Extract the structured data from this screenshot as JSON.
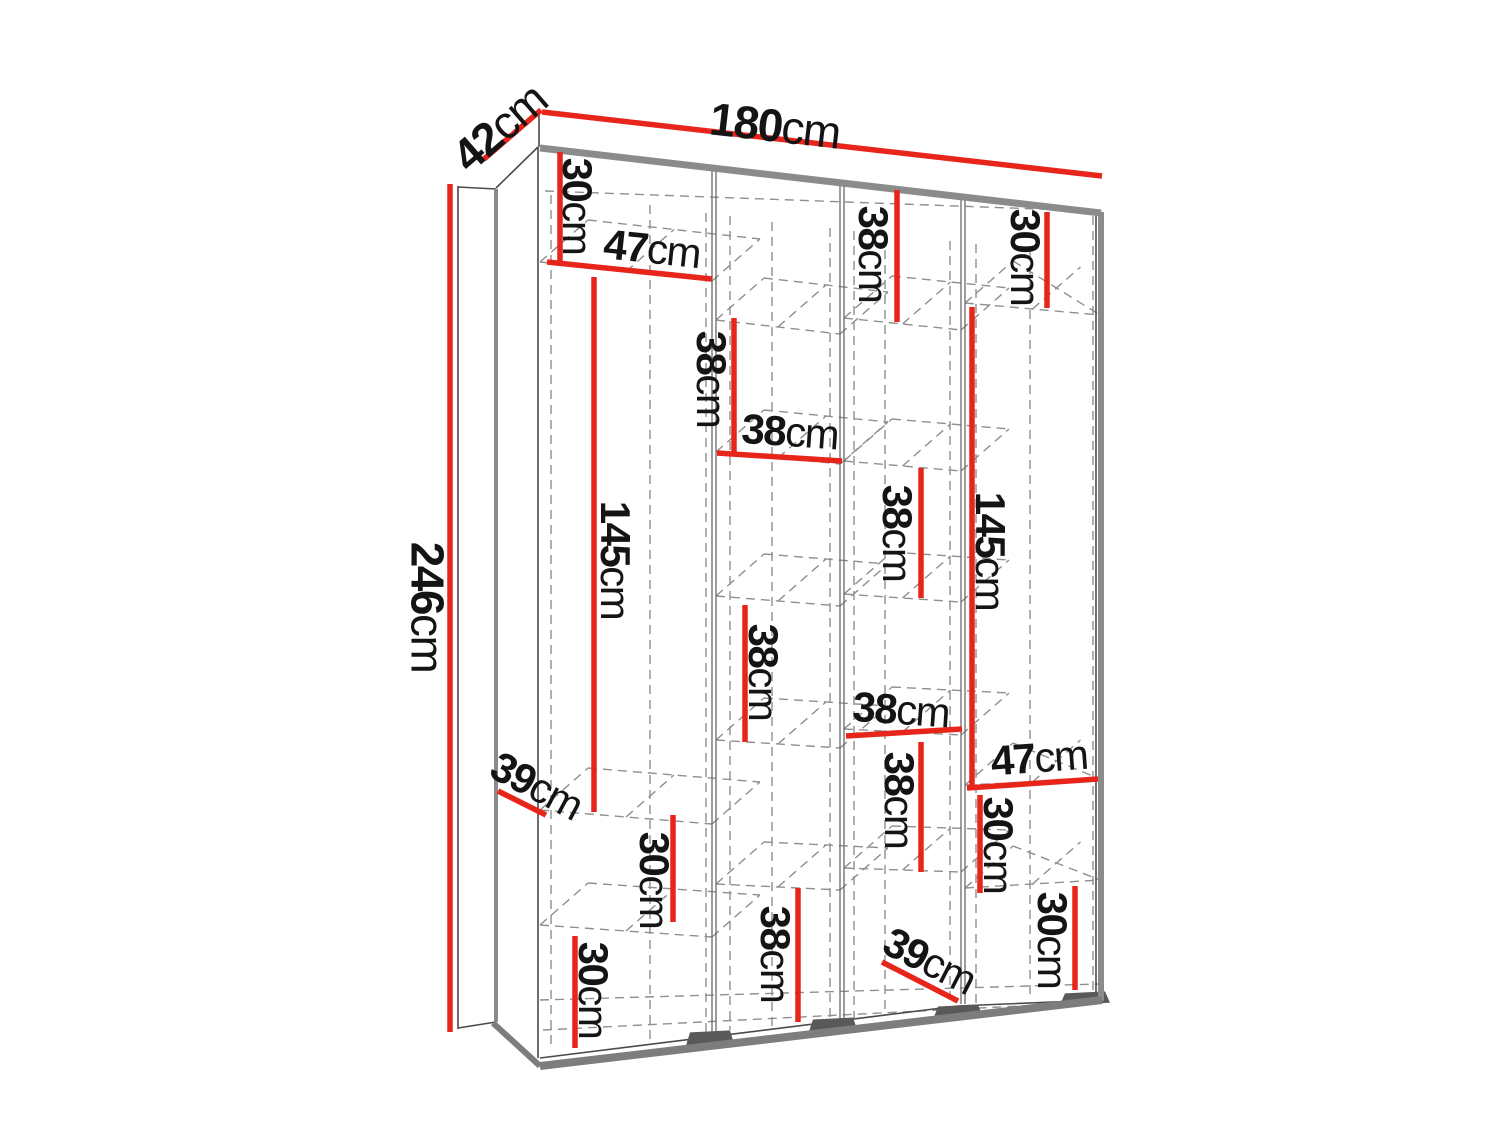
{
  "diagram": {
    "type": "furniture-dimension-diagram",
    "subject": "wardrobe-3d-wireframe-with-shelf-dimensions",
    "unit": "cm",
    "canvas": {
      "width": 1500,
      "height": 1125
    },
    "colors": {
      "background": "#ffffff",
      "dimension_red": "#e8251b",
      "edge_gray": "#8b8b8b",
      "base_gray": "#7d7d7d",
      "feet_gray": "#595959",
      "thin_line": "#4a4a4a",
      "partition_line": "#6a6a6a",
      "dashed_line": "#8f8f8f",
      "text": "#141414"
    },
    "overall_dimensions": [
      {
        "id": "depth",
        "value": "42",
        "unit": "cm",
        "line": [
          484,
          159,
          541,
          110
        ],
        "label": {
          "x": 499,
          "y": 127,
          "rot": -41,
          "size": 46
        }
      },
      {
        "id": "width",
        "value": "180",
        "unit": "cm",
        "line": [
          542,
          112,
          1102,
          176
        ],
        "label": {
          "x": 775,
          "y": 125,
          "rot": 6.5,
          "size": 46
        }
      },
      {
        "id": "height",
        "value": "246",
        "unit": "cm",
        "line": [
          450,
          184,
          450,
          1032
        ],
        "label": {
          "x": 428,
          "y": 607,
          "rot": 90,
          "size": 46
        }
      }
    ],
    "internal_dimensions": [
      {
        "id": "c1-top-30",
        "value": "30",
        "unit": "cm",
        "line": [
          560,
          152,
          560,
          262
        ],
        "label": {
          "x": 578,
          "y": 206,
          "rot": 90
        }
      },
      {
        "id": "c1-width-47",
        "value": "47",
        "unit": "cm",
        "line": [
          547,
          262,
          712,
          279
        ],
        "label": {
          "x": 652,
          "y": 248,
          "rot": 6
        }
      },
      {
        "id": "c1-hang-145",
        "value": "145",
        "unit": "cm",
        "line": [
          594,
          277,
          594,
          812
        ],
        "label": {
          "x": 616,
          "y": 560,
          "rot": 90
        }
      },
      {
        "id": "c1-depth-39",
        "value": "39",
        "unit": "cm",
        "line": [
          498,
          791,
          546,
          815
        ],
        "label": {
          "x": 537,
          "y": 785,
          "rot": 28
        }
      },
      {
        "id": "c1-mid-30",
        "value": "30",
        "unit": "cm",
        "line": [
          673,
          815,
          673,
          922
        ],
        "label": {
          "x": 655,
          "y": 880,
          "rot": 90
        }
      },
      {
        "id": "c1-bot-30",
        "value": "30",
        "unit": "cm",
        "line": [
          575,
          936,
          575,
          1048
        ],
        "label": {
          "x": 594,
          "y": 990,
          "rot": 90
        }
      },
      {
        "id": "c2-cell-38a",
        "value": "38",
        "unit": "cm",
        "line": [
          734,
          318,
          734,
          453
        ],
        "label": {
          "x": 712,
          "y": 379,
          "rot": 90
        }
      },
      {
        "id": "c2-width-38",
        "value": "38",
        "unit": "cm",
        "line": [
          717,
          453,
          842,
          461
        ],
        "label": {
          "x": 790,
          "y": 431,
          "rot": 4
        }
      },
      {
        "id": "c2-cell-38b",
        "value": "38",
        "unit": "cm",
        "line": [
          745,
          605,
          745,
          742
        ],
        "label": {
          "x": 764,
          "y": 672,
          "rot": 90
        }
      },
      {
        "id": "c2-bot-38",
        "value": "38",
        "unit": "cm",
        "line": [
          798,
          888,
          798,
          1022
        ],
        "label": {
          "x": 776,
          "y": 954,
          "rot": 90
        }
      },
      {
        "id": "c3-top-38",
        "value": "38",
        "unit": "cm",
        "line": [
          897,
          190,
          897,
          322
        ],
        "label": {
          "x": 874,
          "y": 254,
          "rot": 90
        }
      },
      {
        "id": "c3-cell-38a",
        "value": "38",
        "unit": "cm",
        "line": [
          921,
          468,
          921,
          598
        ],
        "label": {
          "x": 898,
          "y": 533,
          "rot": 90
        }
      },
      {
        "id": "c3-width-38",
        "value": "38",
        "unit": "cm",
        "line": [
          846,
          736,
          962,
          729
        ],
        "label": {
          "x": 901,
          "y": 709,
          "rot": 4
        }
      },
      {
        "id": "c3-cell-38b",
        "value": "38",
        "unit": "cm",
        "line": [
          921,
          742,
          921,
          872
        ],
        "label": {
          "x": 900,
          "y": 800,
          "rot": 90
        }
      },
      {
        "id": "c3-depth-39",
        "value": "39",
        "unit": "cm",
        "line": [
          882,
          962,
          958,
          1001
        ],
        "label": {
          "x": 930,
          "y": 960,
          "rot": 27
        }
      },
      {
        "id": "c4-top-30",
        "value": "30",
        "unit": "cm",
        "line": [
          1047,
          212,
          1047,
          308
        ],
        "label": {
          "x": 1026,
          "y": 257,
          "rot": 90
        }
      },
      {
        "id": "c4-hang-145",
        "value": "145",
        "unit": "cm",
        "line": [
          972,
          307,
          972,
          788
        ],
        "label": {
          "x": 991,
          "y": 551,
          "rot": 90
        }
      },
      {
        "id": "c4-width-47",
        "value": "47",
        "unit": "cm",
        "line": [
          967,
          788,
          1098,
          779
        ],
        "label": {
          "x": 1039,
          "y": 757,
          "rot": -4
        }
      },
      {
        "id": "c4-mid-30",
        "value": "30",
        "unit": "cm",
        "line": [
          980,
          795,
          980,
          893
        ],
        "label": {
          "x": 999,
          "y": 845,
          "rot": 90
        }
      },
      {
        "id": "c4-bot-30",
        "value": "30",
        "unit": "cm",
        "line": [
          1075,
          886,
          1075,
          990
        ],
        "label": {
          "x": 1053,
          "y": 940,
          "rot": 90
        }
      }
    ],
    "structure": {
      "solid_thin_lines": [
        [
          539,
          111,
          539,
          147
        ],
        [
          538,
          147,
          496,
          188
        ],
        [
          538,
          147,
          538,
          1058
        ],
        [
          1096,
          212,
          1096,
          1001
        ],
        [
          540,
          1058,
          958,
          1006
        ],
        [
          958,
          1006,
          1100,
          1000
        ],
        [
          458,
          186,
          458,
          1029
        ],
        [
          458,
          187,
          496,
          189
        ],
        [
          458,
          1028,
          496,
          1022
        ]
      ],
      "thick_lines": [
        {
          "pts": [
            540,
            148,
            1101,
            213
          ],
          "w": 7,
          "c": "edge"
        },
        {
          "pts": [
            1101,
            212,
            1101,
            1001
          ],
          "w": 6,
          "c": "edge"
        },
        {
          "pts": [
            496,
            189,
            496,
            1022
          ],
          "w": 4,
          "c": "edge"
        },
        {
          "pts": [
            493,
            1023,
            540,
            1066
          ],
          "w": 6,
          "c": "base"
        },
        {
          "pts": [
            540,
            1066,
            1102,
            1000
          ],
          "w": 8,
          "c": "base"
        }
      ],
      "partitions": [
        {
          "x": 712,
          "y1": 167,
          "y2": 1038
        },
        {
          "x": 840,
          "y1": 182,
          "y2": 1022
        },
        {
          "x": 961,
          "y1": 196,
          "y2": 1004
        }
      ],
      "dashed_lines": [
        [
          545,
          191,
          1093,
          211
        ],
        [
          540,
          1000,
          1099,
          984
        ],
        [
          543,
          1030,
          1099,
          1002
        ]
      ],
      "dashed_verticals": [
        [
          551,
          195,
          1050
        ],
        [
          650,
          205,
          1042
        ],
        [
          706,
          213,
          1034
        ],
        [
          730,
          216,
          1030
        ],
        [
          772,
          222,
          1026
        ],
        [
          830,
          228,
          1022
        ],
        [
          854,
          231,
          1018
        ],
        [
          885,
          235,
          1014
        ],
        [
          950,
          241,
          1008
        ],
        [
          976,
          244,
          1004
        ],
        [
          1030,
          250,
          1000
        ],
        [
          1093,
          216,
          996
        ]
      ],
      "shelves": [
        {
          "x1": 540,
          "y1": 262,
          "x2": 712,
          "y2": 281
        },
        {
          "x1": 540,
          "y1": 810,
          "x2": 712,
          "y2": 824
        },
        {
          "x1": 540,
          "y1": 925,
          "x2": 712,
          "y2": 937
        },
        {
          "x1": 716,
          "y1": 320,
          "x2": 840,
          "y2": 334
        },
        {
          "x1": 716,
          "y1": 452,
          "x2": 840,
          "y2": 464
        },
        {
          "x1": 716,
          "y1": 596,
          "x2": 840,
          "y2": 606
        },
        {
          "x1": 716,
          "y1": 740,
          "x2": 840,
          "y2": 748
        },
        {
          "x1": 716,
          "y1": 884,
          "x2": 840,
          "y2": 890
        },
        {
          "x1": 844,
          "y1": 318,
          "x2": 961,
          "y2": 330
        },
        {
          "x1": 844,
          "y1": 461,
          "x2": 961,
          "y2": 471
        },
        {
          "x1": 844,
          "y1": 594,
          "x2": 961,
          "y2": 602
        },
        {
          "x1": 844,
          "y1": 729,
          "x2": 961,
          "y2": 735
        },
        {
          "x1": 844,
          "y1": 868,
          "x2": 961,
          "y2": 872
        },
        {
          "x1": 965,
          "y1": 303,
          "x2": 1100,
          "y2": 315
        },
        {
          "x1": 965,
          "y1": 785,
          "x2": 1100,
          "y2": 779
        },
        {
          "x1": 965,
          "y1": 888,
          "x2": 1100,
          "y2": 880
        }
      ],
      "feet_x": [
        710,
        833,
        958,
        1085
      ]
    }
  }
}
